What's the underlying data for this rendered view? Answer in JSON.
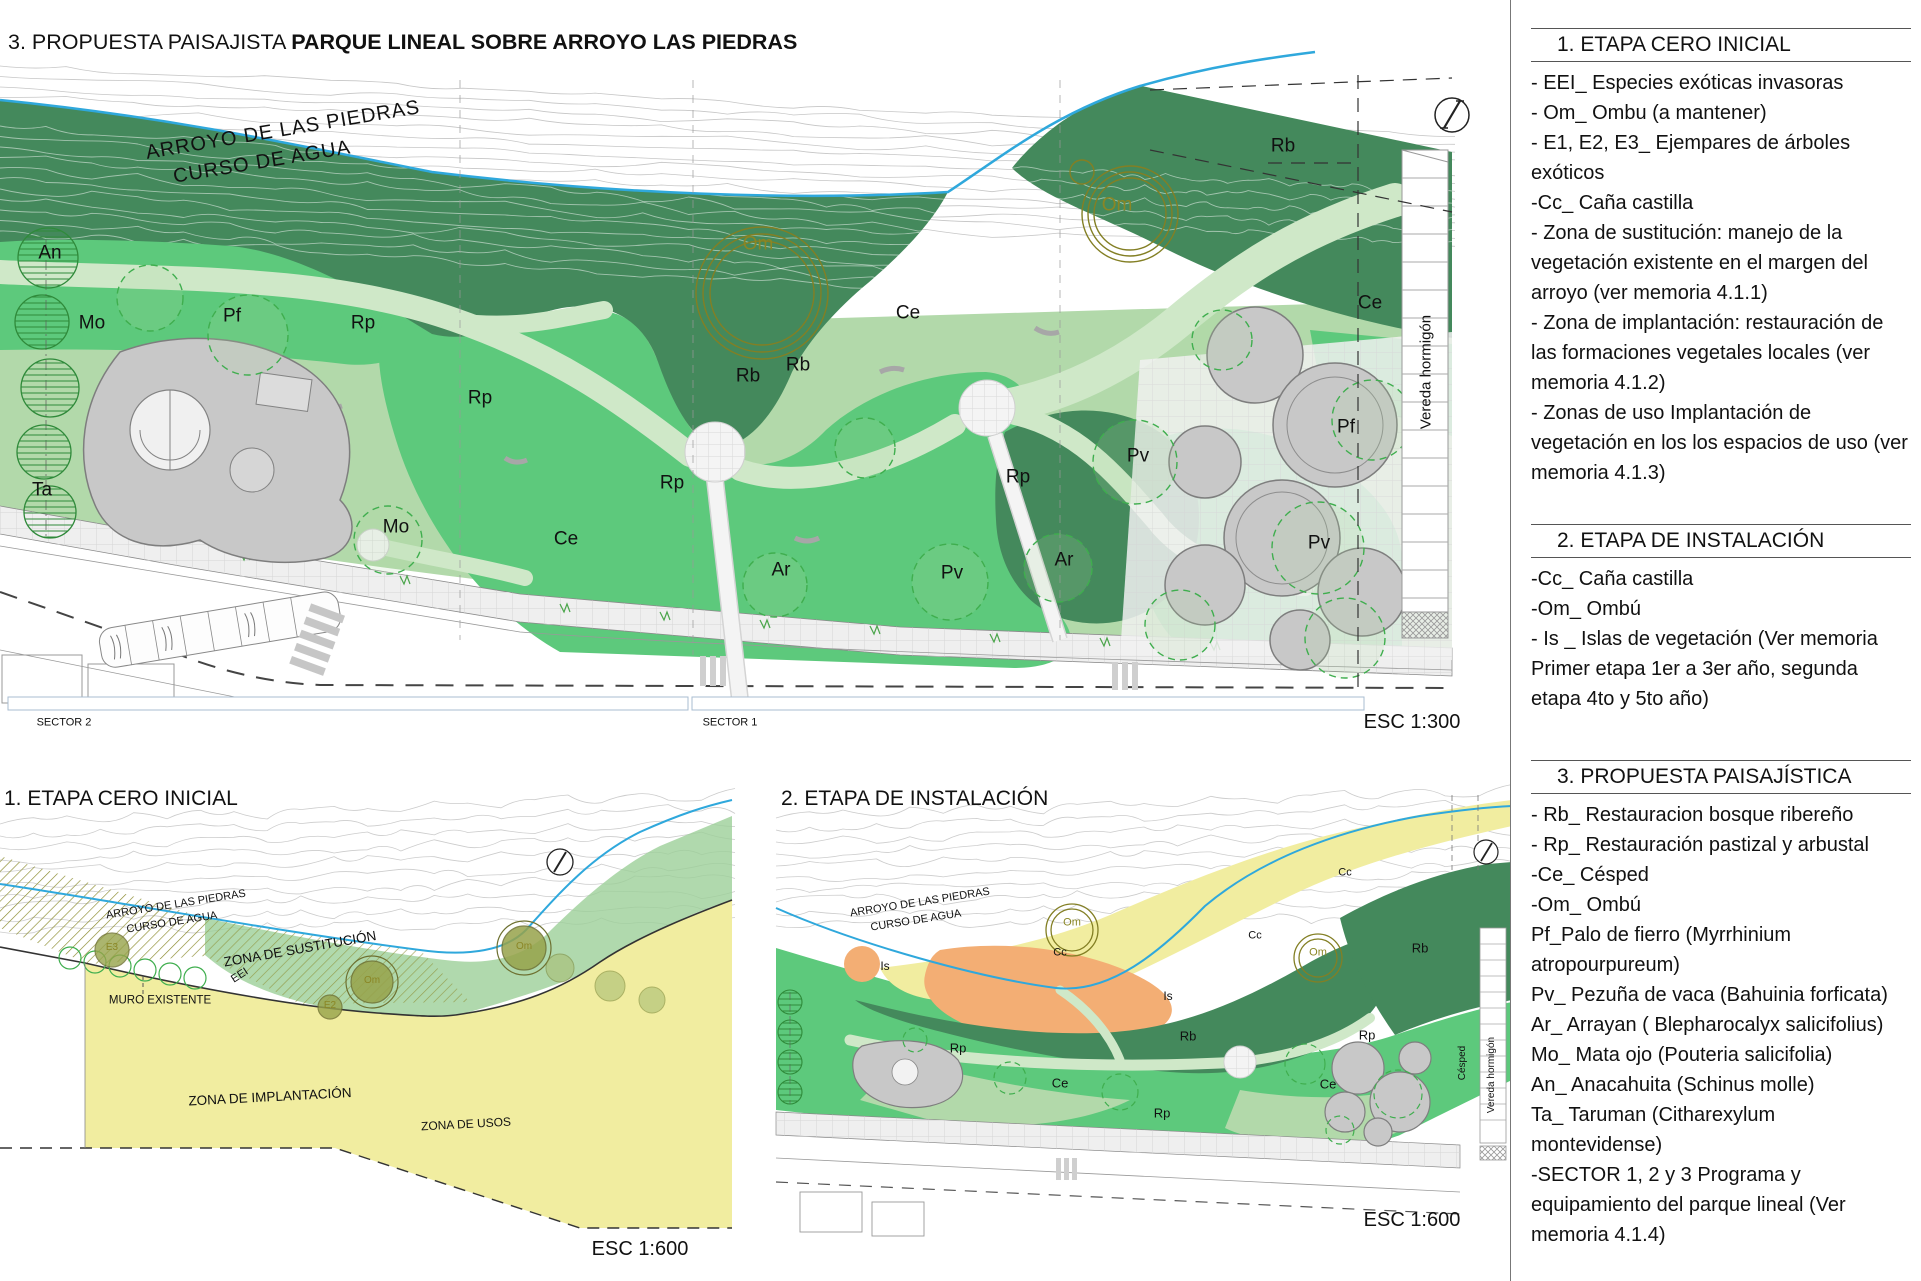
{
  "title": {
    "prefix": "3. PROPUESTA PAISAJISTA ",
    "main": "PARQUE LINEAL SOBRE ARROYO LAS PIEDRAS"
  },
  "sidebar": {
    "sections": [
      {
        "heading": "1. ETAPA CERO INICIAL",
        "items": [
          "- EEI_ Especies exóticas invasoras",
          "- Om_ Ombu (a mantener)",
          "- E1, E2, E3_ Ejempares de árboles exóticos",
          "-Cc_ Caña castilla",
          "- Zona de sustitución: manejo de la vegetación existente en el margen del arroyo (ver memoria 4.1.1)",
          "- Zona de implantación: restauración de las formaciones vegetales locales (ver memoria 4.1.2)",
          "- Zonas de uso Implantación de vegetación en los los espacios de uso (ver memoria 4.1.3)"
        ]
      },
      {
        "heading": "2.  ETAPA DE INSTALACIÓN",
        "items": [
          "-Cc_ Caña castilla",
          "-Om_ Ombú",
          "- Is _ Islas de vegetación  (Ver memoria Primer etapa 1er a 3er año, segunda etapa 4to y 5to año)"
        ]
      },
      {
        "heading": "3. PROPUESTA PAISAJÍSTICA",
        "items": [
          "- Rb_ Restauracion bosque ribereño",
          "- Rp_ Restauración pastizal y arbustal",
          "-Ce_ Césped",
          "-Om_ Ombú",
          "Pf_Palo de fierro (Myrrhinium atropourpureum)",
          "Pv_ Pezuña de vaca (Bahuinia forficata)",
          "Ar_  Arrayan ( Blepharocalyx salicifolius)",
          "Mo_ Mata ojo (Pouteria salicifolia)",
          "An_ Anacahuita (Schinus molle)",
          "Ta_ Taruman (Citharexylum montevidense)",
          "-SECTOR 1, 2 y 3  Programa y equipamiento del parque lineal (Ver memoria 4.1.4)"
        ]
      }
    ]
  },
  "main_plan": {
    "scale_label": "ESC 1:300",
    "labels": [
      {
        "t": "ARROYO DE LAS PIEDRAS",
        "x": 283,
        "y": 130,
        "s": 20,
        "r": -9.5,
        "ls": 1,
        "n": "stream-name-label"
      },
      {
        "t": "CURSO DE AGUA",
        "x": 262,
        "y": 162,
        "s": 20,
        "r": -9.5,
        "ls": 1,
        "n": "stream-course-label"
      },
      {
        "t": "An",
        "x": 50,
        "y": 253,
        "s": 19
      },
      {
        "t": "Mo",
        "x": 92,
        "y": 323,
        "s": 19
      },
      {
        "t": "Pf",
        "x": 232,
        "y": 316,
        "s": 19
      },
      {
        "t": "Rp",
        "x": 363,
        "y": 323,
        "s": 19
      },
      {
        "t": "Ta",
        "x": 42,
        "y": 490,
        "s": 19
      },
      {
        "t": "Mo",
        "x": 396,
        "y": 527,
        "s": 19
      },
      {
        "t": "Ce",
        "x": 566,
        "y": 539,
        "s": 19
      },
      {
        "t": "Rp",
        "x": 480,
        "y": 398,
        "s": 19
      },
      {
        "t": "Rp",
        "x": 672,
        "y": 483,
        "s": 19
      },
      {
        "t": "Rb",
        "x": 748,
        "y": 376,
        "s": 19
      },
      {
        "t": "Rb",
        "x": 798,
        "y": 365,
        "s": 19
      },
      {
        "t": "Ce",
        "x": 908,
        "y": 313,
        "s": 19
      },
      {
        "t": "Rp",
        "x": 1018,
        "y": 477,
        "s": 19
      },
      {
        "t": "Ar",
        "x": 781,
        "y": 570,
        "s": 19
      },
      {
        "t": "Pv",
        "x": 952,
        "y": 573,
        "s": 19
      },
      {
        "t": "Ar",
        "x": 1064,
        "y": 560,
        "s": 19
      },
      {
        "t": "Pv",
        "x": 1138,
        "y": 456,
        "s": 19
      },
      {
        "t": "Pv",
        "x": 1319,
        "y": 543,
        "s": 19
      },
      {
        "t": "Pf",
        "x": 1346,
        "y": 427,
        "s": 19
      },
      {
        "t": "Ce",
        "x": 1370,
        "y": 303,
        "s": 19
      },
      {
        "t": "Rb",
        "x": 1283,
        "y": 146,
        "s": 19
      },
      {
        "t": "Om",
        "x": 758,
        "y": 244,
        "s": 19,
        "c": "olive"
      },
      {
        "t": "Om",
        "x": 1117,
        "y": 205,
        "s": 19,
        "c": "olive"
      },
      {
        "t": "Vereda hormigón",
        "x": 1426,
        "y": 372,
        "s": 15,
        "r": -90,
        "n": "sidewalk-label"
      },
      {
        "t": "SECTOR 2",
        "x": 64,
        "y": 723,
        "s": 11,
        "n": "sector-2-label"
      },
      {
        "t": "SECTOR 1",
        "x": 730,
        "y": 723,
        "s": 11,
        "n": "sector-1-label"
      },
      {
        "t": "ESC 1:300",
        "x": 1412,
        "y": 722,
        "s": 20,
        "n": "scale-label"
      }
    ]
  },
  "drawing_1": {
    "title": "1. ETAPA CERO INICIAL",
    "labels": [
      {
        "t": "ARROYO DE LAS PIEDRAS",
        "x": 176,
        "y": 905,
        "s": 11,
        "r": -9,
        "n": "stream-name-label"
      },
      {
        "t": "CURSO DE AGUA",
        "x": 172,
        "y": 923,
        "s": 11,
        "r": -9,
        "n": "stream-course-label"
      },
      {
        "t": "ZONA DE SUSTITUCIÓN",
        "x": 300,
        "y": 949,
        "s": 13.5,
        "r": -10,
        "n": "zone-label"
      },
      {
        "t": "EEI",
        "x": 240,
        "y": 976,
        "s": 11,
        "r": -33
      },
      {
        "t": "MURO EXISTENTE",
        "x": 160,
        "y": 1001,
        "s": 11.5,
        "n": "wall-label"
      },
      {
        "t": "ZONA DE IMPLANTACIÓN",
        "x": 270,
        "y": 1097,
        "s": 13.5,
        "r": -3,
        "n": "zone-label"
      },
      {
        "t": "ZONA DE USOS",
        "x": 466,
        "y": 1124,
        "s": 12,
        "r": -3,
        "n": "zone-label"
      },
      {
        "t": "E3",
        "x": 112,
        "y": 948,
        "s": 10,
        "c": "olive"
      },
      {
        "t": "E2",
        "x": 330,
        "y": 1006,
        "s": 10,
        "c": "olive"
      },
      {
        "t": "Om",
        "x": 372,
        "y": 981,
        "s": 10,
        "c": "olive"
      },
      {
        "t": "Om",
        "x": 524,
        "y": 947,
        "s": 10,
        "c": "olive"
      },
      {
        "t": "ESC 1:600",
        "x": 640,
        "y": 1249,
        "s": 20,
        "n": "scale-label"
      }
    ]
  },
  "drawing_2": {
    "title": "2.  ETAPA DE INSTALACIÓN",
    "labels": [
      {
        "t": "ARROYO DE LAS PIEDRAS",
        "x": 920,
        "y": 903,
        "s": 11,
        "r": -9,
        "n": "stream-name-label"
      },
      {
        "t": "CURSO DE AGUA",
        "x": 916,
        "y": 921,
        "s": 11,
        "r": -9,
        "n": "stream-course-label"
      },
      {
        "t": "Is",
        "x": 885,
        "y": 966,
        "s": 12
      },
      {
        "t": "Is",
        "x": 1168,
        "y": 996,
        "s": 12
      },
      {
        "t": "Cc",
        "x": 1060,
        "y": 953,
        "s": 11
      },
      {
        "t": "Cc",
        "x": 1255,
        "y": 936,
        "s": 11
      },
      {
        "t": "Cc",
        "x": 1345,
        "y": 873,
        "s": 11
      },
      {
        "t": "Om",
        "x": 1072,
        "y": 923,
        "s": 11,
        "c": "olive"
      },
      {
        "t": "Om",
        "x": 1318,
        "y": 953,
        "s": 11,
        "c": "olive"
      },
      {
        "t": "Rb",
        "x": 1188,
        "y": 1036,
        "s": 13
      },
      {
        "t": "Rb",
        "x": 1420,
        "y": 948,
        "s": 13
      },
      {
        "t": "Rp",
        "x": 958,
        "y": 1048,
        "s": 13
      },
      {
        "t": "Rp",
        "x": 1367,
        "y": 1035,
        "s": 13
      },
      {
        "t": "Rp",
        "x": 1162,
        "y": 1113,
        "s": 13
      },
      {
        "t": "Ce",
        "x": 1060,
        "y": 1083,
        "s": 13
      },
      {
        "t": "Ce",
        "x": 1328,
        "y": 1084,
        "s": 13
      },
      {
        "t": "Césped",
        "x": 1463,
        "y": 1063,
        "s": 10,
        "r": -90,
        "n": "lawn-label"
      },
      {
        "t": "Vereda hormigón",
        "x": 1492,
        "y": 1075,
        "s": 10,
        "r": -90,
        "n": "sidewalk-label"
      },
      {
        "t": "ESC 1:600",
        "x": 1412,
        "y": 1220,
        "s": 20,
        "n": "scale-label"
      }
    ]
  },
  "colors": {
    "riparian_forest": "#44895c",
    "grass_shrub": "#5dc97c",
    "lawn": "#b2d9aa",
    "path": "#cfe8c8",
    "stream": "#2fa8dc",
    "olive": "#8a8625",
    "stage_yellow": "#f1eda0",
    "veg_island_orange": "#f3ae74",
    "gray_equipment": "#c8c8c8",
    "sector_bar_stroke": "#a9bdd1"
  }
}
